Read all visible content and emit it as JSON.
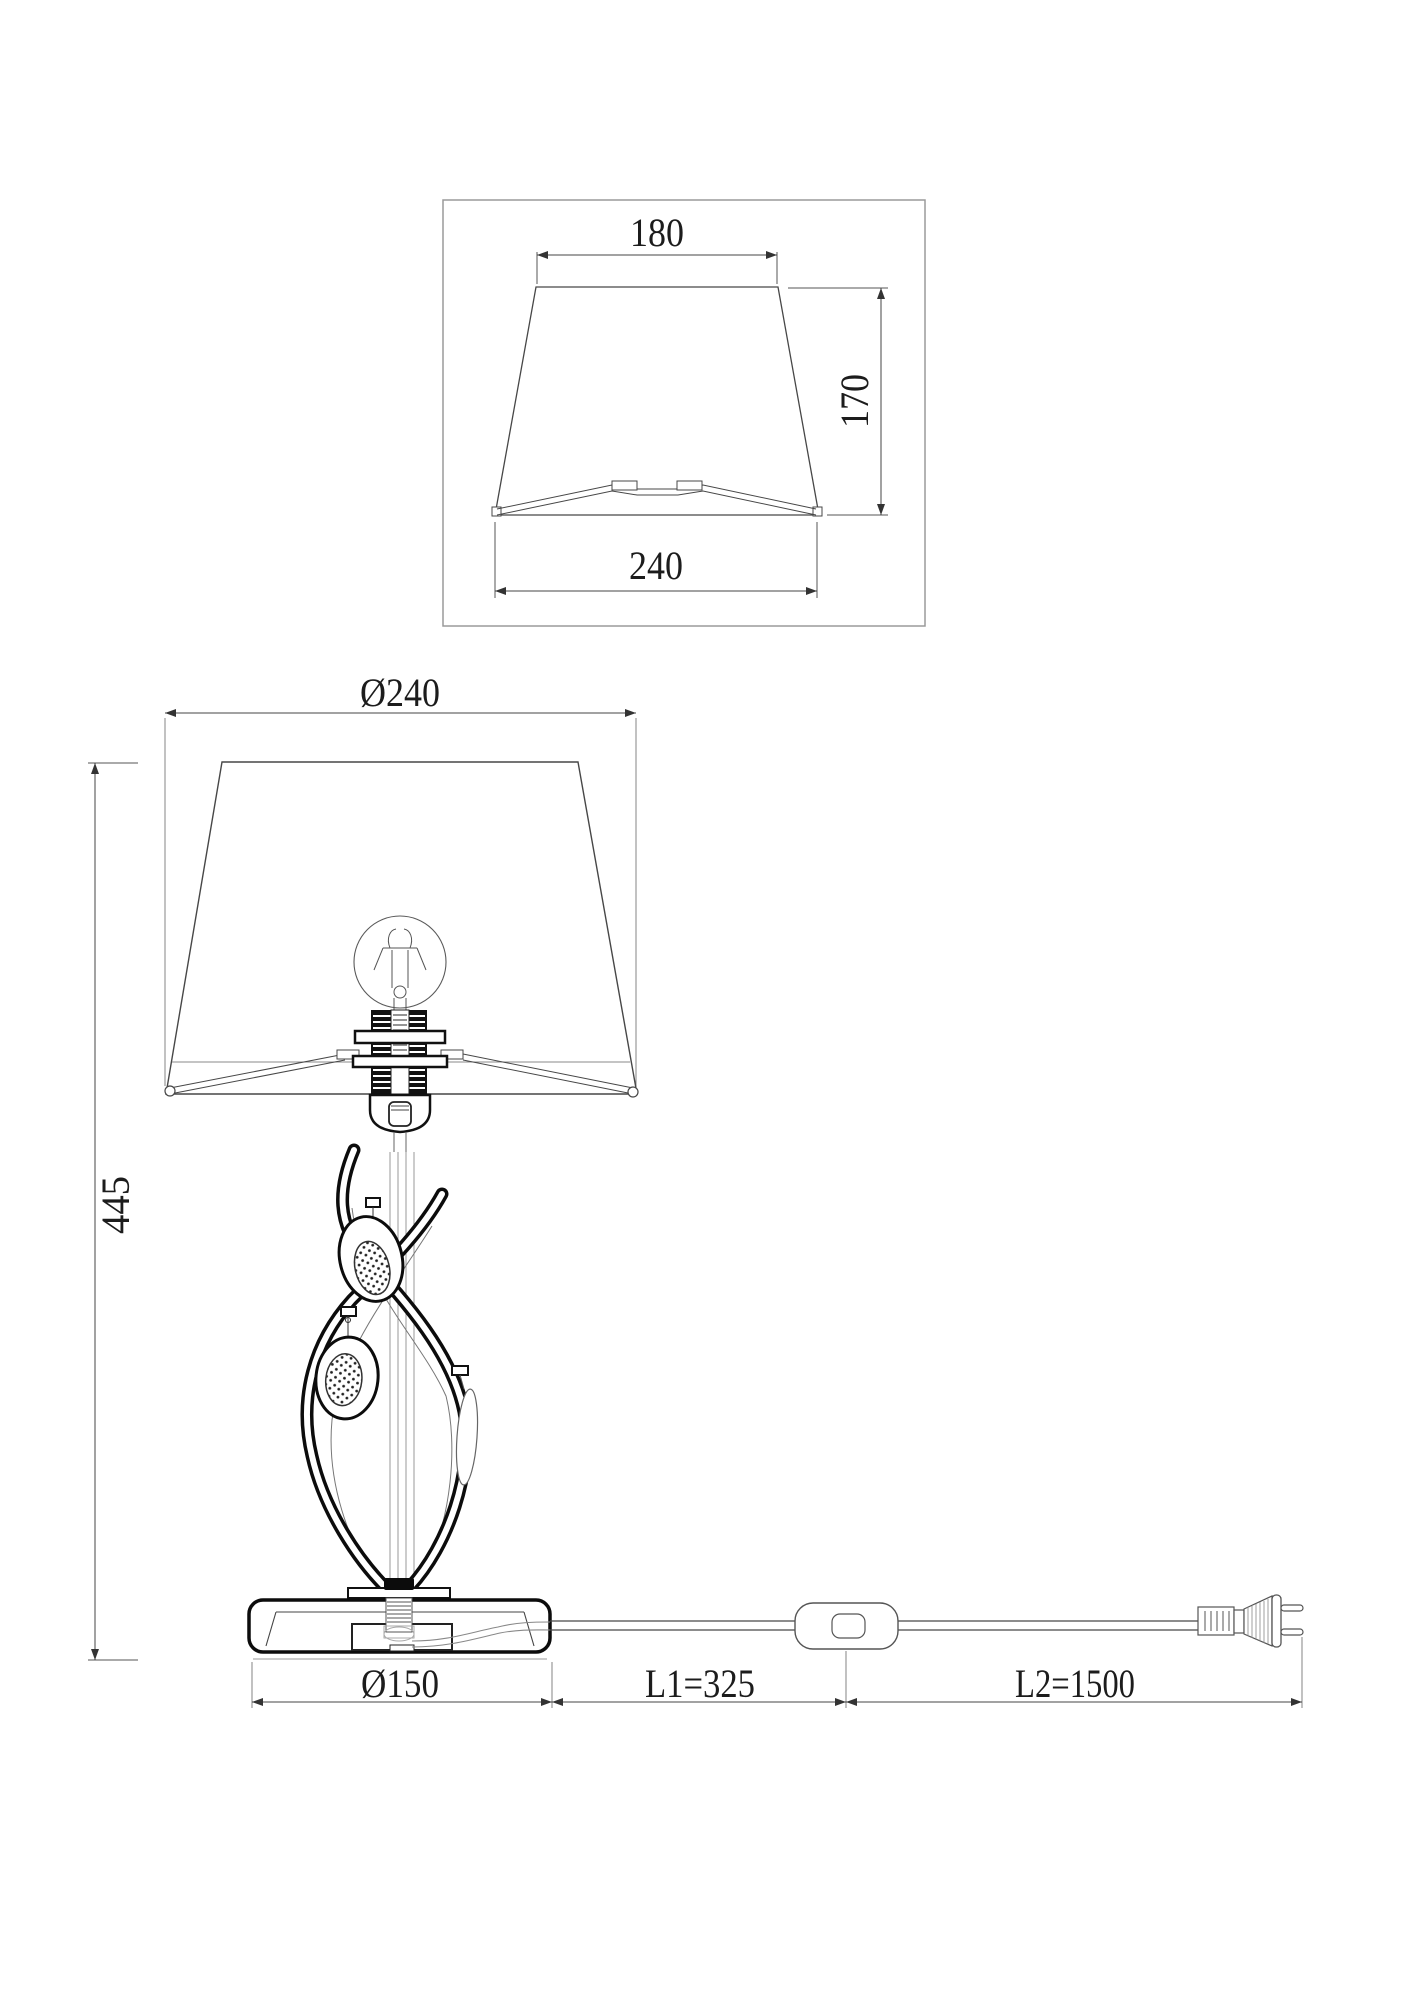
{
  "page": {
    "background": "#ffffff",
    "line_color": "#2b2b2b",
    "accent_black": "#0c0c0c"
  },
  "shade_detail_view": {
    "top_width_label": "180",
    "height_label": "170",
    "bottom_width_label": "240"
  },
  "front_view": {
    "shade_diameter_label": "Ø240",
    "total_height_label": "445",
    "base_diameter_label": "Ø150",
    "switch_distance_label": "L1=325",
    "cord_length_label": "L2=1500"
  }
}
